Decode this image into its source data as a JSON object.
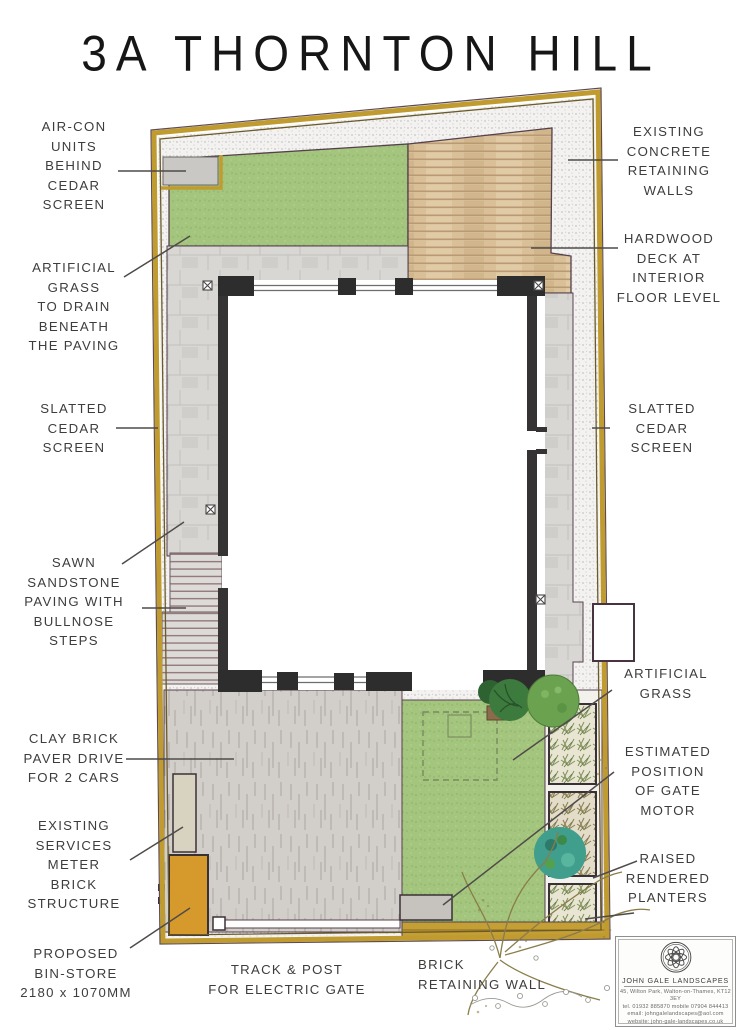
{
  "title": "3A THORNTON HILL",
  "annotations": {
    "aircon": "AIR-CON\nUNITS\nBEHIND\nCEDAR\nSCREEN",
    "artificial_grass_drain": "ARTIFICIAL\nGRASS\nTO DRAIN\nBENEATH\nTHE PAVING",
    "slatted_cedar_left": "SLATTED\nCEDAR\nSCREEN",
    "sawn_sandstone": "SAWN\nSANDSTONE\nPAVING WITH\nBULLNOSE\nSTEPS",
    "clay_brick_drive": "CLAY BRICK\nPAVER DRIVE\nFOR 2 CARS",
    "services_meter": "EXISTING\nSERVICES\nMETER\nBRICK\nSTRUCTURE",
    "bin_store": "PROPOSED\nBIN-STORE\n2180 x 1070MM",
    "existing_concrete": "EXISTING\nCONCRETE\nRETAINING\nWALLS",
    "hardwood_deck": "HARDWOOD\nDECK AT\nINTERIOR\nFLOOR LEVEL",
    "slatted_cedar_right": "SLATTED\nCEDAR\nSCREEN",
    "artificial_grass": "ARTIFICIAL\nGRASS",
    "gate_motor": "ESTIMATED\nPOSITION\nOF GATE\nMOTOR",
    "raised_planters": "RAISED\nRENDERED\nPLANTERS",
    "track_post": "TRACK & POST\nFOR ELECTRIC GATE",
    "brick_retaining": "BRICK\nRETAINING WALL"
  },
  "logo": {
    "name": "JOHN GALE LANDSCAPES",
    "address": "45, Wilton Park, Walton-on-Thames, KT12 3EY",
    "phone": "tel. 01932 885870    mobile 07904 844413",
    "email": "email: johngalelandscapes@aol.com",
    "website": "website: john-gale-landscapes.co.uk"
  },
  "colors": {
    "grass": "#a3c57d",
    "deck": "#d9c098",
    "paving": "#d8d7d4",
    "drive": "#d2cfcb",
    "fence_gold": "#bf9b30",
    "wall_dark": "#353334",
    "bin_store": "#d6992c",
    "meter_box": "#d8d2c0",
    "ink": "#3e3d3c"
  }
}
